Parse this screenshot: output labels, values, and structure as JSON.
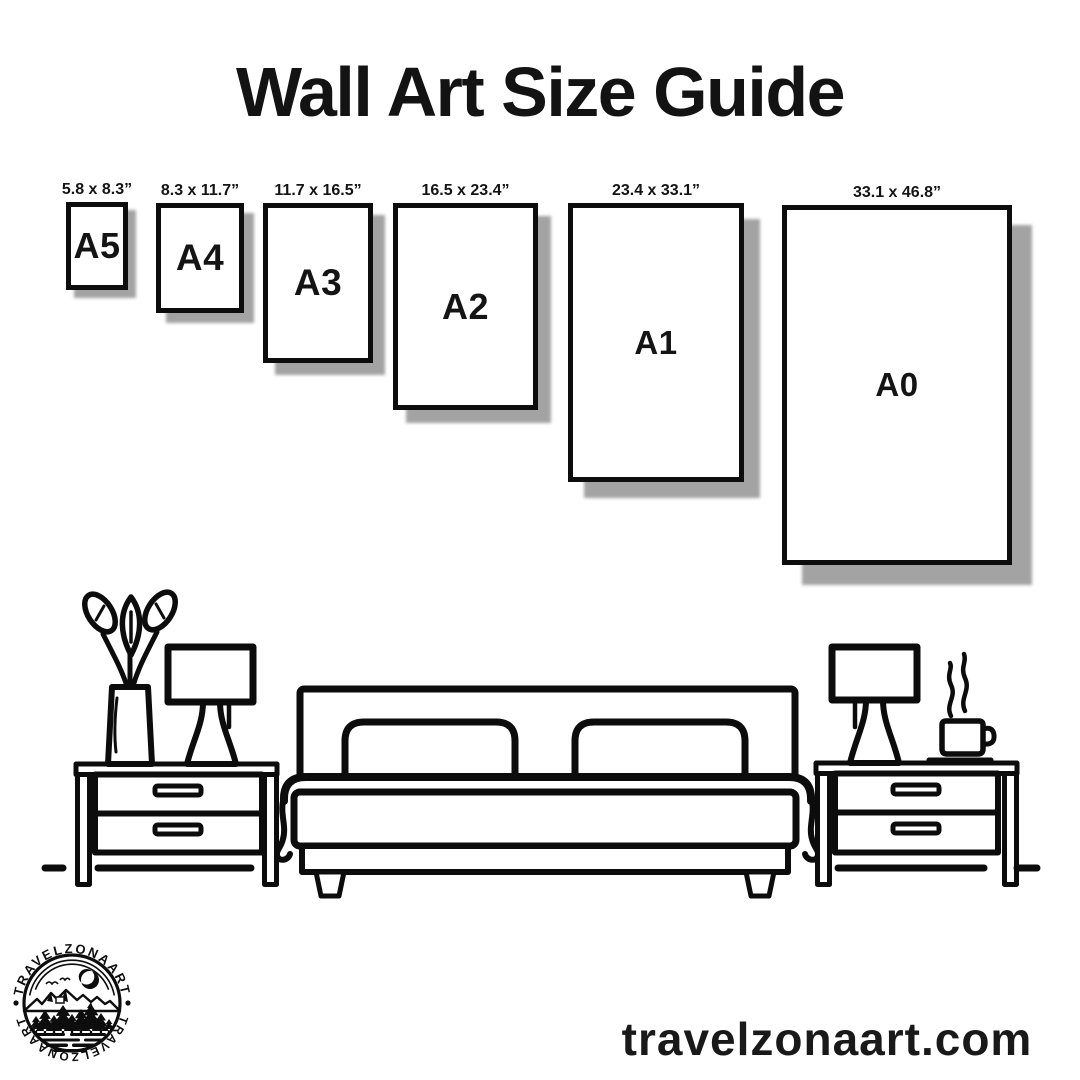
{
  "title": "Wall Art Size Guide",
  "sizes": [
    {
      "code": "A5",
      "dims": "5.8 x 8.3”",
      "x": 66,
      "y": 202,
      "w": 62,
      "h": 88,
      "shadow": 8,
      "font": 36
    },
    {
      "code": "A4",
      "dims": "8.3 x 11.7”",
      "x": 156,
      "y": 203,
      "w": 88,
      "h": 110,
      "shadow": 10,
      "font": 37
    },
    {
      "code": "A3",
      "dims": "11.7 x 16.5”",
      "x": 263,
      "y": 203,
      "w": 110,
      "h": 160,
      "shadow": 12,
      "font": 37
    },
    {
      "code": "A2",
      "dims": "16.5 x 23.4”",
      "x": 393,
      "y": 203,
      "w": 145,
      "h": 207,
      "shadow": 13,
      "font": 36
    },
    {
      "code": "A1",
      "dims": "23.4 x 33.1”",
      "x": 568,
      "y": 203,
      "w": 176,
      "h": 279,
      "shadow": 16,
      "font": 33
    },
    {
      "code": "A0",
      "dims": "33.1 x 46.8”",
      "x": 782,
      "y": 205,
      "w": 230,
      "h": 360,
      "shadow": 20,
      "font": 33
    }
  ],
  "footer": {
    "website": "travelzonaart.com"
  },
  "logo": {
    "brand_top": "TRAVELZONAART",
    "brand_bottom": "TRAVELZONAART"
  },
  "colors": {
    "ink": "#0d0d0d",
    "shadow": "#a3a3a3",
    "background": "#ffffff"
  }
}
